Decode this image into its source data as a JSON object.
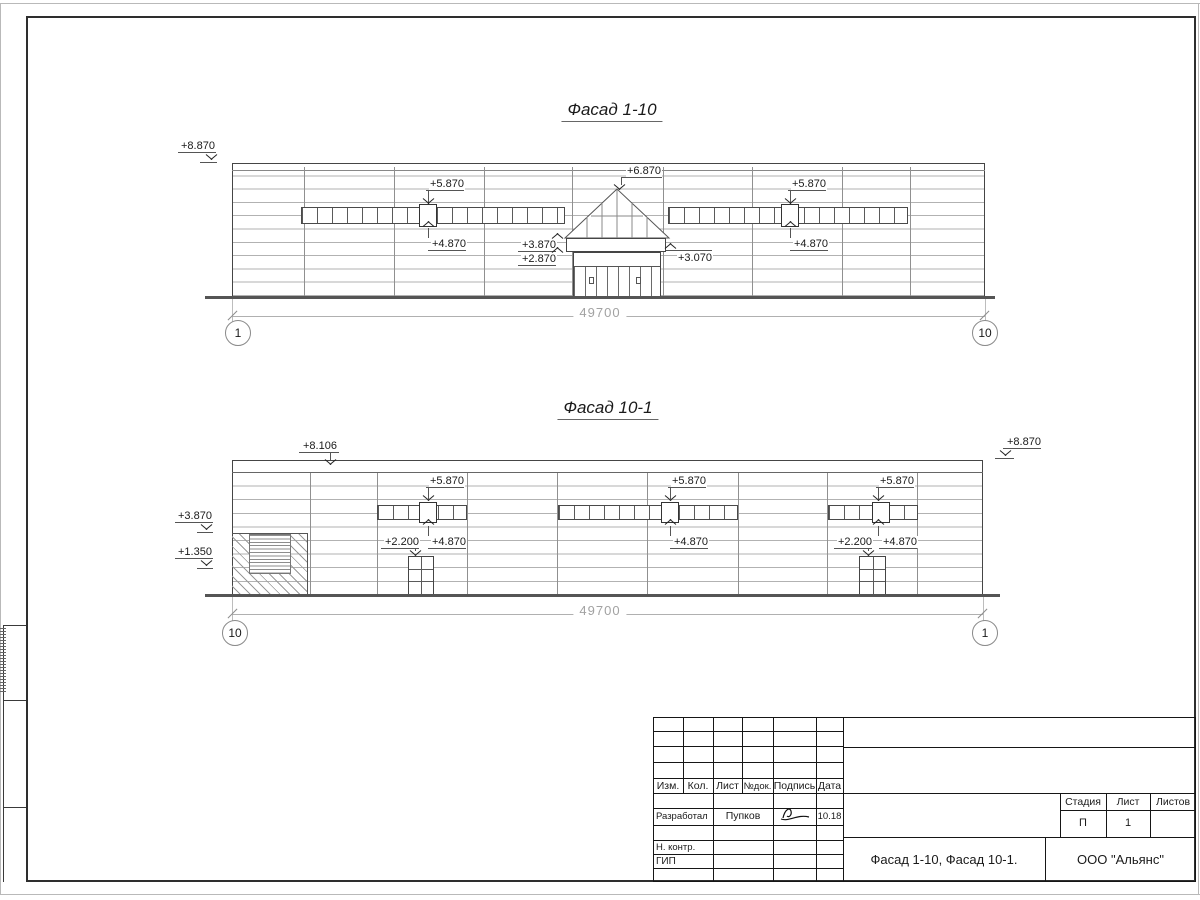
{
  "facade1": {
    "title": "Фасад 1-10",
    "dimension": "49700",
    "bubble_left": "1",
    "bubble_right": "10",
    "columns": [
      304,
      394,
      484,
      572,
      663,
      752,
      842,
      910
    ],
    "window_bands": [
      {
        "windows": 18
      },
      {
        "windows": 16
      }
    ],
    "marks": [
      {
        "t": "+8.870",
        "tx": 180,
        "ty": 140,
        "shelf": [
          178,
          152,
          38
        ],
        "arrow": [
          206,
          154,
          "down"
        ],
        "base": [
          200,
          162,
          17
        ]
      },
      {
        "t": "+5.870",
        "tx": 429,
        "ty": 178,
        "shelf": [
          426,
          190,
          38
        ],
        "leader": [
          428,
          190,
          14
        ],
        "arrow": [
          423,
          198,
          "down"
        ]
      },
      {
        "t": "+4.870",
        "tx": 431,
        "ty": 238,
        "shelf": [
          428,
          250,
          38
        ],
        "leader": [
          428,
          228,
          10
        ],
        "arrow": [
          423,
          221,
          "up"
        ]
      },
      {
        "t": "+6.870",
        "tx": 626,
        "ty": 165,
        "shelf": [
          622,
          177,
          40
        ],
        "leader": [
          621,
          177,
          8
        ],
        "arrow": [
          614,
          184,
          "down"
        ]
      },
      {
        "t": "+5.870",
        "tx": 791,
        "ty": 178,
        "shelf": [
          788,
          190,
          38
        ],
        "leader": [
          790,
          190,
          14
        ],
        "arrow": [
          785,
          198,
          "down"
        ]
      },
      {
        "t": "+4.870",
        "tx": 793,
        "ty": 238,
        "shelf": [
          790,
          250,
          38
        ],
        "leader": [
          790,
          228,
          10
        ],
        "arrow": [
          785,
          221,
          "up"
        ]
      },
      {
        "t": "+3.870",
        "tx": 521,
        "ty": 239,
        "shelf": [
          518,
          251,
          38
        ],
        "arrow": [
          552,
          233,
          "up"
        ]
      },
      {
        "t": "+2.870",
        "tx": 521,
        "ty": 253,
        "shelf": [
          518,
          265,
          38
        ],
        "arrow": [
          552,
          247,
          "up"
        ]
      },
      {
        "t": "+3.070",
        "tx": 677,
        "ty": 252,
        "shelf": [
          666,
          250,
          46
        ],
        "arrow": [
          665,
          243,
          "up"
        ]
      }
    ]
  },
  "facade2": {
    "title": "Фасад 10-1",
    "dimension": "49700",
    "bubble_left": "10",
    "bubble_right": "1",
    "columns": [
      310,
      377,
      467,
      557,
      647,
      738,
      827,
      917
    ],
    "window_bands": [
      {
        "windows": 6
      },
      {
        "windows": 12
      },
      {
        "windows": 6
      }
    ],
    "marks": [
      {
        "t": "+8.106",
        "tx": 302,
        "ty": 440,
        "shelf": [
          299,
          452,
          40
        ],
        "leader": [
          330,
          452,
          8
        ],
        "arrow": [
          325,
          459,
          "down"
        ]
      },
      {
        "t": "+8.870",
        "tx": 1006,
        "ty": 436,
        "shelf": [
          1003,
          448,
          38
        ],
        "arrow": [
          1000,
          450,
          "down"
        ],
        "base": [
          995,
          458,
          19
        ]
      },
      {
        "t": "+3.870",
        "tx": 177,
        "ty": 510,
        "shelf": [
          175,
          522,
          38
        ],
        "arrow": [
          201,
          524,
          "down"
        ],
        "base": [
          197,
          532,
          16
        ]
      },
      {
        "t": "+1.350",
        "tx": 177,
        "ty": 546,
        "shelf": [
          175,
          558,
          38
        ],
        "arrow": [
          201,
          560,
          "down"
        ],
        "base": [
          197,
          568,
          16
        ]
      },
      {
        "t": "+5.870",
        "tx": 429,
        "ty": 475,
        "shelf": [
          426,
          487,
          38
        ],
        "leader": [
          428,
          487,
          12
        ],
        "arrow": [
          423,
          495,
          "down"
        ]
      },
      {
        "t": "+4.870",
        "tx": 431,
        "ty": 536,
        "shelf": [
          428,
          548,
          38
        ],
        "leader": [
          428,
          526,
          10
        ],
        "arrow": [
          423,
          519,
          "up"
        ]
      },
      {
        "t": "+2.200",
        "tx": 384,
        "ty": 536,
        "shelf": [
          381,
          548,
          38
        ],
        "leader": [
          415,
          548,
          3
        ],
        "arrow": [
          410,
          550,
          "down"
        ]
      },
      {
        "t": "+5.870",
        "tx": 671,
        "ty": 475,
        "shelf": [
          668,
          487,
          38
        ],
        "leader": [
          670,
          487,
          12
        ],
        "arrow": [
          665,
          495,
          "down"
        ]
      },
      {
        "t": "+4.870",
        "tx": 673,
        "ty": 536,
        "shelf": [
          670,
          548,
          38
        ],
        "leader": [
          670,
          526,
          10
        ],
        "arrow": [
          665,
          519,
          "up"
        ]
      },
      {
        "t": "+5.870",
        "tx": 879,
        "ty": 475,
        "shelf": [
          876,
          487,
          38
        ],
        "leader": [
          878,
          487,
          12
        ],
        "arrow": [
          873,
          495,
          "down"
        ]
      },
      {
        "t": "+4.870",
        "tx": 882,
        "ty": 536,
        "shelf": [
          879,
          548,
          38
        ],
        "leader": [
          878,
          526,
          10
        ],
        "arrow": [
          873,
          519,
          "up"
        ]
      },
      {
        "t": "+2.200",
        "tx": 837,
        "ty": 536,
        "shelf": [
          834,
          548,
          38
        ],
        "leader": [
          868,
          548,
          3
        ],
        "arrow": [
          863,
          550,
          "down"
        ]
      }
    ]
  },
  "stamp": {
    "headers": [
      "Изм.",
      "Кол.",
      "Лист",
      "№док.",
      "Подпись",
      "Дата"
    ],
    "role_developed": "Разработал",
    "developed_by": "Пупков",
    "date": "10.18",
    "role_ncontrol": "Н. контр.",
    "role_gip": "ГИП",
    "stage_headers": [
      "Стадия",
      "Лист",
      "Листов"
    ],
    "stage_value": "П",
    "sheet_value": "1",
    "sheets_total_value": "",
    "doc_title": "Фасад 1-10, Фасад 10-1.",
    "organization": "ООО \"Альянс\""
  },
  "colors": {
    "line_dark": "#3a3a3a",
    "line_light": "#b2b2b2",
    "dim_gray": "#a2a2a2",
    "paper": "#ffffff"
  }
}
